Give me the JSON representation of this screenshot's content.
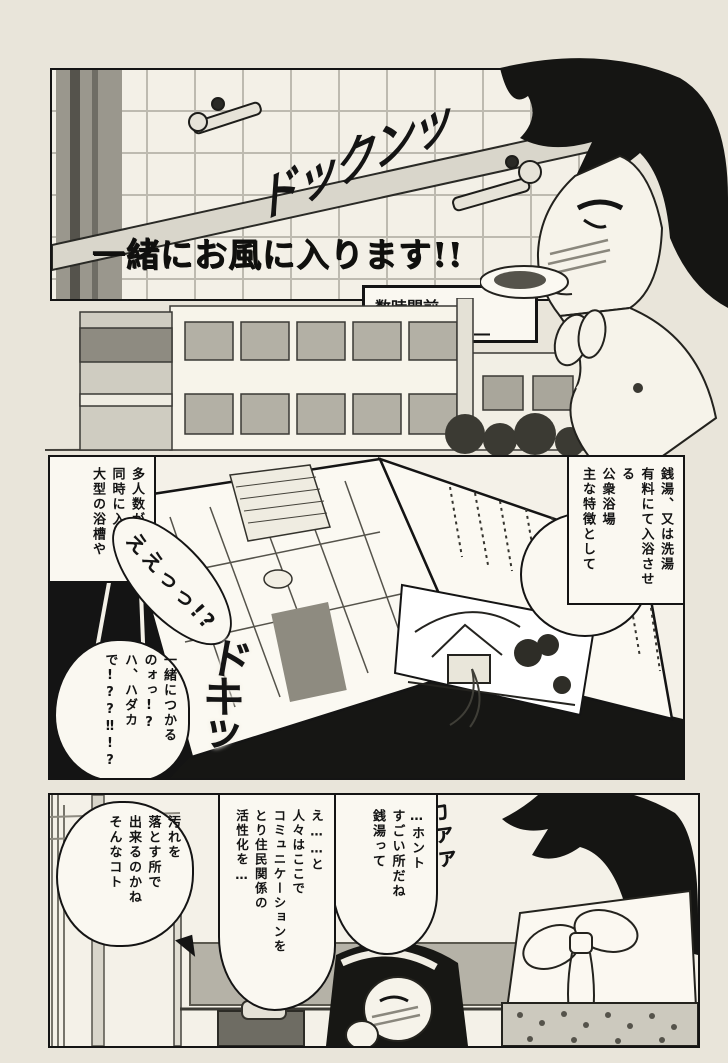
{
  "page": {
    "bg": "#e9e5da",
    "panel_bg": "#f4f1e8",
    "ink": "#141414"
  },
  "panel_bath": {
    "title": "一緒にお風に入ります!!",
    "sfx_heartbeat": "ドックンッ"
  },
  "scene_caption": {
    "line1": "数時間前",
    "line2": "―図書館―"
  },
  "panel_book": {
    "caption_right": {
      "line1": "銭湯、又は洗湯",
      "line2": "有料にて入浴させる",
      "line3": "公衆浴場",
      "line4": "主な特徴として"
    },
    "caption_left": {
      "line1": "多人数が",
      "line2": "同時に入れる",
      "line3": "大型の浴槽や"
    },
    "bubble_shock": "ええっっ!?",
    "bubble_question": {
      "line1": "一緒につかる",
      "line2": "のォっ!?",
      "line3": "ハ、ハダカ",
      "line4": "で!??‼!?"
    },
    "sfx_shock": "ドキッ"
  },
  "panel_classroom": {
    "bubble_right": {
      "line1": "…ホント",
      "line2": "すごい所だね",
      "line3": "銭湯って"
    },
    "bubble_middle": {
      "line1": "え……と",
      "line2": "人々はここで",
      "line3": "コミュニケーションを",
      "line4": "とり住民関係の",
      "line5": "活性化を…"
    },
    "bubble_left": {
      "line1": "汚れを",
      "line2": "落とす所で",
      "line3": "出来るのかね",
      "line4": "そんなコト"
    },
    "sfx_blush": "カァァ"
  }
}
